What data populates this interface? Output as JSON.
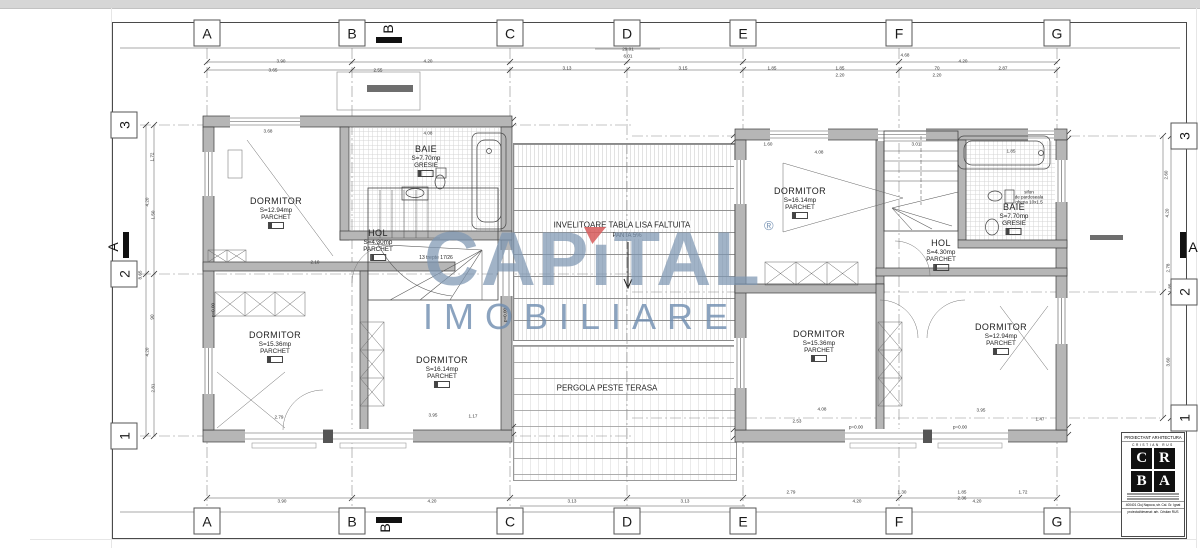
{
  "watermark": {
    "cap_left": "CAP",
    "cap_i": "ı",
    "cap_right": "TAL",
    "line2": "IMOBILIARE",
    "registered": "®",
    "blue": "#7d96b2",
    "red": "#d75f5f"
  },
  "sections": {
    "top": "B",
    "bottom": "B",
    "left": "A",
    "right": "A"
  },
  "axes": [
    {
      "t": "A",
      "x": 207,
      "y": 33
    },
    {
      "t": "B",
      "x": 352,
      "y": 33
    },
    {
      "t": "C",
      "x": 510,
      "y": 33
    },
    {
      "t": "D",
      "x": 627,
      "y": 33
    },
    {
      "t": "E",
      "x": 743,
      "y": 33
    },
    {
      "t": "F",
      "x": 899,
      "y": 33
    },
    {
      "t": "G",
      "x": 1057,
      "y": 33
    },
    {
      "t": "A",
      "x": 207,
      "y": 521
    },
    {
      "t": "B",
      "x": 352,
      "y": 521
    },
    {
      "t": "C",
      "x": 510,
      "y": 521
    },
    {
      "t": "D",
      "x": 627,
      "y": 521
    },
    {
      "t": "E",
      "x": 743,
      "y": 521
    },
    {
      "t": "F",
      "x": 899,
      "y": 521
    },
    {
      "t": "G",
      "x": 1057,
      "y": 521
    },
    {
      "t": "3",
      "x": 124,
      "y": 125,
      "r": -90
    },
    {
      "t": "2",
      "x": 124,
      "y": 274,
      "r": -90
    },
    {
      "t": "1",
      "x": 124,
      "y": 436,
      "r": -90
    },
    {
      "t": "3",
      "x": 1184,
      "y": 136,
      "r": -90
    },
    {
      "t": "2",
      "x": 1184,
      "y": 292,
      "r": -90
    },
    {
      "t": "1",
      "x": 1184,
      "y": 418,
      "r": -90
    }
  ],
  "rooms": [
    {
      "x": 276,
      "y": 196,
      "lines": [
        "DORMITOR",
        "S=12.94mp",
        "PARCHET"
      ]
    },
    {
      "x": 426,
      "y": 144,
      "lines": [
        "BAIE",
        "S=7.70mp",
        "GRESIE"
      ]
    },
    {
      "x": 378,
      "y": 228,
      "lines": [
        "HOL",
        "S=4.30mp",
        "PARCHET"
      ]
    },
    {
      "x": 275,
      "y": 330,
      "lines": [
        "DORMITOR",
        "S=15.36mp",
        "PARCHET"
      ]
    },
    {
      "x": 442,
      "y": 355,
      "lines": [
        "DORMITOR",
        "S=16.14mp",
        "PARCHET"
      ]
    },
    {
      "x": 800,
      "y": 186,
      "lines": [
        "DORMITOR",
        "S=16.14mp",
        "PARCHET"
      ]
    },
    {
      "x": 1014,
      "y": 202,
      "lines": [
        "BAIE",
        "S=7.70mp",
        "GRESIE"
      ]
    },
    {
      "x": 941,
      "y": 238,
      "lines": [
        "HOL",
        "S=4.30mp",
        "PARCHET"
      ]
    },
    {
      "x": 819,
      "y": 329,
      "lines": [
        "DORMITOR",
        "S=15.36mp",
        "PARCHET"
      ]
    },
    {
      "x": 1001,
      "y": 322,
      "lines": [
        "DORMITOR",
        "S=12.94mp",
        "PARCHET"
      ]
    }
  ],
  "annotations": [
    {
      "t": "INVELITOARE TABLA LISA FALTUITA",
      "x": 622,
      "y": 225,
      "fs": 8,
      "bg": 1
    },
    {
      "t": "PANTA 5%",
      "x": 627,
      "y": 236,
      "fs": 6,
      "bg": 1
    },
    {
      "t": "PERGOLA PESTE TERASA",
      "x": 607,
      "y": 388,
      "fs": 8,
      "bg": 1
    },
    {
      "t": "13 trepte 17/26",
      "x": 436,
      "y": 258,
      "fs": 5
    },
    {
      "t": "sifon",
      "x": 1029,
      "y": 192,
      "fs": 4.5
    },
    {
      "t": "de pardoseala",
      "x": 1029,
      "y": 197,
      "fs": 4.5
    },
    {
      "t": "ghena 10x1.5",
      "x": 1029,
      "y": 202,
      "fs": 4.5
    },
    {
      "t": "p=0.00",
      "x": 856,
      "y": 427,
      "fs": 4.5
    },
    {
      "t": "p=0.00",
      "x": 960,
      "y": 427,
      "fs": 4.5
    },
    {
      "t": "p=0.00",
      "x": 213,
      "y": 310,
      "fs": 4.5,
      "r": -90
    },
    {
      "t": "p=0.00",
      "x": 505,
      "y": 315,
      "fs": 4.5,
      "r": -90
    }
  ],
  "dims": [
    {
      "t": "29.01",
      "x": 628,
      "y": 49
    },
    {
      "t": "6.01",
      "x": 628,
      "y": 56
    },
    {
      "t": "3.90",
      "x": 281,
      "y": 61
    },
    {
      "t": "4.20",
      "x": 428,
      "y": 61
    },
    {
      "t": "3.13",
      "x": 567,
      "y": 68
    },
    {
      "t": "3.15",
      "x": 683,
      "y": 68
    },
    {
      "t": "3.65",
      "x": 273,
      "y": 70
    },
    {
      "t": "2.55",
      "x": 378,
      "y": 70
    },
    {
      "t": "4.68",
      "x": 905,
      "y": 55
    },
    {
      "t": "4.20",
      "x": 963,
      "y": 61
    },
    {
      "t": "1.85",
      "x": 772,
      "y": 68
    },
    {
      "t": "1.85",
      "x": 840,
      "y": 68
    },
    {
      "t": "2.20",
      "x": 840,
      "y": 75
    },
    {
      "t": "70",
      "x": 937,
      "y": 68
    },
    {
      "t": "2.20",
      "x": 937,
      "y": 75
    },
    {
      "t": "2.87",
      "x": 1003,
      "y": 68
    },
    {
      "t": "3.90",
      "x": 282,
      "y": 501
    },
    {
      "t": "4.20",
      "x": 432,
      "y": 501
    },
    {
      "t": "3.13",
      "x": 572,
      "y": 501
    },
    {
      "t": "3.13",
      "x": 685,
      "y": 501
    },
    {
      "t": "29.01",
      "x": 627,
      "y": 509
    },
    {
      "t": "2.79",
      "x": 791,
      "y": 492
    },
    {
      "t": "4.20",
      "x": 857,
      "y": 501
    },
    {
      "t": "1.30",
      "x": 902,
      "y": 492
    },
    {
      "t": "1.85",
      "x": 962,
      "y": 492
    },
    {
      "t": "2.36",
      "x": 962,
      "y": 498
    },
    {
      "t": "1.72",
      "x": 1023,
      "y": 492
    },
    {
      "t": "4.20",
      "x": 977,
      "y": 501
    },
    {
      "t": "1.72",
      "x": 152,
      "y": 157,
      "r": -90
    },
    {
      "t": "4.20",
      "x": 147,
      "y": 202,
      "r": -90
    },
    {
      "t": "1.50",
      "x": 153,
      "y": 215,
      "r": -90
    },
    {
      "t": "8.65",
      "x": 140,
      "y": 275,
      "r": -90
    },
    {
      "t": "90",
      "x": 152,
      "y": 317,
      "r": -90
    },
    {
      "t": "4.20",
      "x": 147,
      "y": 352,
      "r": -90
    },
    {
      "t": "2.81",
      "x": 153,
      "y": 388,
      "r": -90
    },
    {
      "t": "2.60",
      "x": 1166,
      "y": 175,
      "r": -90
    },
    {
      "t": "4.20",
      "x": 1167,
      "y": 213,
      "r": -90
    },
    {
      "t": "2.78",
      "x": 1168,
      "y": 268,
      "r": -90
    },
    {
      "t": "1.85",
      "x": 1170,
      "y": 288,
      "r": -90
    },
    {
      "t": "3.60",
      "x": 1168,
      "y": 362,
      "r": -90
    },
    {
      "t": "3.68",
      "x": 268,
      "y": 131
    },
    {
      "t": "4.08",
      "x": 428,
      "y": 133
    },
    {
      "t": "2.10",
      "x": 315,
      "y": 262
    },
    {
      "t": "2.79",
      "x": 279,
      "y": 417
    },
    {
      "t": "3.95",
      "x": 433,
      "y": 415
    },
    {
      "t": "1.17",
      "x": 473,
      "y": 416
    },
    {
      "t": "1.60",
      "x": 768,
      "y": 144
    },
    {
      "t": "3.01",
      "x": 916,
      "y": 144
    },
    {
      "t": "4.08",
      "x": 819,
      "y": 152
    },
    {
      "t": "1.85",
      "x": 1011,
      "y": 151
    },
    {
      "t": "2.53",
      "x": 797,
      "y": 421
    },
    {
      "t": "4.08",
      "x": 822,
      "y": 409
    },
    {
      "t": "3.95",
      "x": 981,
      "y": 410
    },
    {
      "t": "1.47",
      "x": 1040,
      "y": 419
    }
  ],
  "titleblock": {
    "header": "PROIECTANT ARHITECTURA",
    "name": "CRISTIAN RUS",
    "logo": [
      "C",
      "R",
      "B",
      "A"
    ],
    "address": "400401 Cluj Napoca, str. Cal. Gr. Ignat",
    "credit": "proiectat/desenat: arh. Cristian RUS"
  }
}
